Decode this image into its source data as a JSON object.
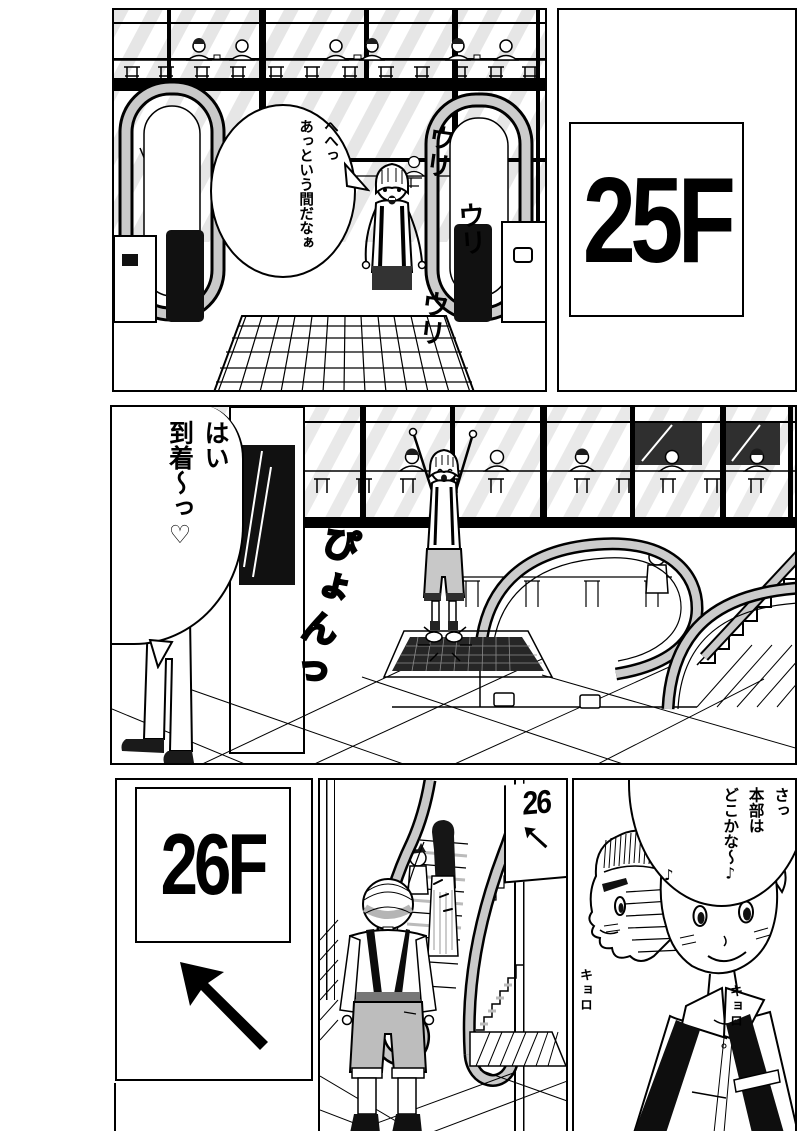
{
  "panel1": {
    "bubble": {
      "col1": "へへっ",
      "col2": "あっという間だなぁ"
    },
    "sfx": {
      "s1": "ウリ",
      "s2": "ウリ",
      "s3": "ウリ"
    }
  },
  "panel2": {
    "floor_sign": "25F"
  },
  "panel3": {
    "bubble": {
      "col1": "はい",
      "col2": "到着〜っ♡"
    },
    "sfx": "ぴょんっ"
  },
  "panel4": {
    "floor_sign": "26F"
  },
  "panel5": {
    "wall_sign": "26"
  },
  "panel6": {
    "bubble": {
      "col1": "さっ",
      "col2": "本部は",
      "col3": "どこかな〜♪"
    },
    "sfx_left": "キョロ",
    "sfx_right": "キョロ",
    "note": "♪"
  }
}
